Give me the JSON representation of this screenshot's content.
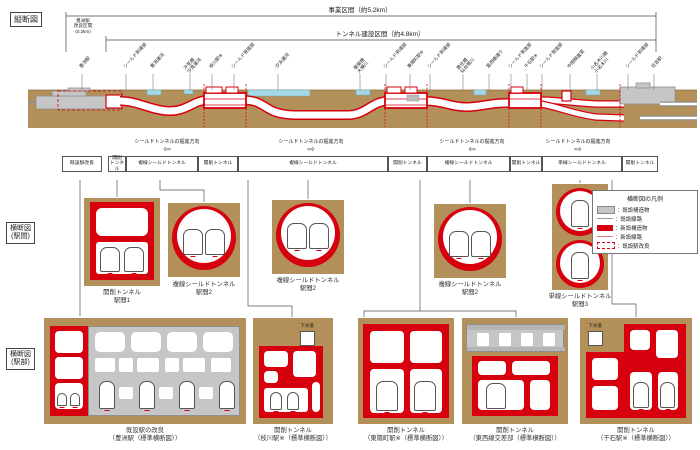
{
  "left_labels": {
    "profile": "縦断図",
    "mid": "横断図\n(駅間)",
    "bottom": "横断図\n(駅部)"
  },
  "profile": {
    "business_span": "事業区間（約5.2km）",
    "tunnel_span": "トンネル建設区間（約4.8km）",
    "toyosu_improve": "豊洲駅\n改良区間\n(0.2km)",
    "direction_label": "シールドトンネルの掘進方向",
    "direction_arrows": [
      "⇦",
      "⇨",
      "⇦",
      "⇨"
    ],
    "slant": [
      "豊洲駅",
      "シールド到達部",
      "豊洲運河",
      "汐見橋\n汐見運河",
      "枝川駅※",
      "シールド発進部",
      "汐浜運河",
      "東陽橋\n大横川",
      "シールド到達部",
      "東陽町駅※",
      "シールド到達部",
      "豊住橋\n仙台堀川",
      "葛西橋通り",
      "シールド発進部",
      "千石駅※",
      "シールド発進部",
      "中間検査室",
      "小名木川橋\n小名木川",
      "シールド到達部",
      "住吉駅"
    ]
  },
  "segments": [
    "既設駅改良",
    "開削\nトンネル",
    "複線シールドトンネル",
    "開削トンネル",
    "複線シールドトンネル",
    "開削トンネル",
    "複線シールドトンネル",
    "開削トンネル",
    "単線シールドトンネル",
    "開削トンネル"
  ],
  "mid_sections": {
    "captions": [
      "開削トンネル\n駅間1",
      "複線シールドトンネル\n駅間2",
      "複線シールドトンネル\n駅間2",
      "複線シールドトンネル\n駅間2",
      "単線シールドトンネル\n駅間3"
    ]
  },
  "legend": {
    "title": "横断図の凡例",
    "items": [
      "：既設構造物",
      "：既設線路",
      "：新設構造物",
      "：新設線路",
      "：既設駅改良"
    ]
  },
  "station_sections": {
    "sewer": "下水道",
    "captions": [
      "既設駅の改良\n（豊洲駅（標準横断図））",
      "開削トンネル\n（枝川駅※（標準横断図））",
      "開削トンネル\n（東陽町駅※（標準横断図））",
      "開削トンネル\n（東西線交差部（標準横断図））",
      "開削トンネル\n（千石駅※（標準横断図））"
    ]
  },
  "colors": {
    "ground": "#b3905a",
    "new_structure": "#d7000f",
    "existing_structure": "#c6c6c6",
    "water": "#a5d7e5"
  }
}
